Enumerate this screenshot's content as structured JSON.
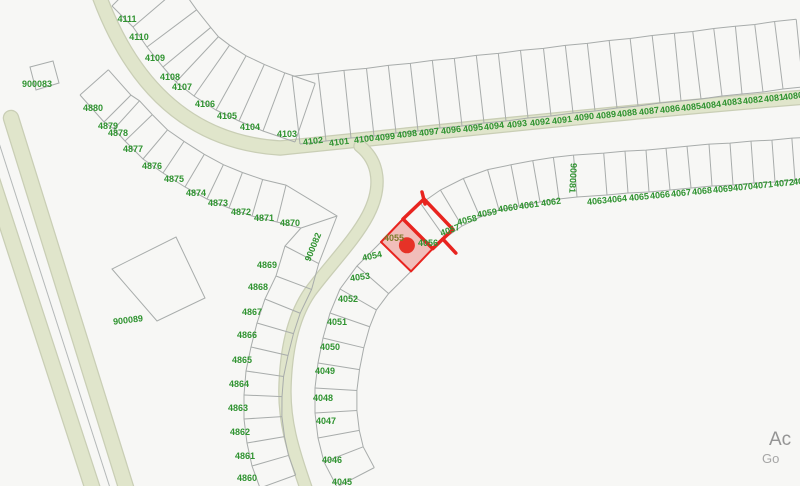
{
  "map": {
    "selected_parcel": "4055",
    "parcels": {
      "arc_nw": [
        "4111",
        "4110",
        "4109",
        "4108",
        "4107",
        "4106",
        "4105",
        "4104",
        "4103"
      ],
      "row_north": [
        "4102",
        "4101",
        "4100",
        "4099",
        "4098",
        "4097",
        "4096",
        "4095",
        "4094",
        "4093",
        "4092",
        "4091",
        "4090",
        "4089",
        "4088",
        "4087",
        "4086",
        "4085",
        "4084",
        "4083",
        "4082",
        "4081",
        "4080"
      ],
      "row_east": [
        "4057",
        "4058",
        "4059",
        "4060",
        "4061",
        "4062",
        "900081",
        "4063",
        "4064",
        "4065",
        "4066",
        "4067",
        "4068",
        "4069",
        "4070",
        "4071",
        "4072",
        "4073"
      ],
      "column_inner": [
        "4056",
        "4055",
        "4054",
        "4053",
        "4052",
        "4051",
        "4050",
        "4049",
        "4048",
        "4047",
        "4046",
        "4045"
      ],
      "arc_west": [
        "4880",
        "4879",
        "4878",
        "4877",
        "4876",
        "4875",
        "4874",
        "4873",
        "4872",
        "4871",
        "4870",
        "900082",
        "4869",
        "4868",
        "4867",
        "4866",
        "4865",
        "4864",
        "4863",
        "4862",
        "4861",
        "4860"
      ],
      "standalone": [
        "900083",
        "900089"
      ]
    },
    "colors": {
      "label_green": "#2f9330",
      "label_olive": "#7c7a28",
      "selection_red": "#e8241f",
      "selection_fill": "rgba(230,60,50,0.30)",
      "marker_red": "#e63227",
      "road_fill": "#e0e5cb",
      "road_edge": "#c9ceb5",
      "parcel_line": "#a8acab",
      "background": "#f7f7f5",
      "divided_road_line": "#b4b8b8",
      "attribution_primary": "#949494",
      "attribution_secondary": "#a6a6a6"
    }
  },
  "attribution": {
    "line1": "Ac",
    "line2": "Go"
  }
}
